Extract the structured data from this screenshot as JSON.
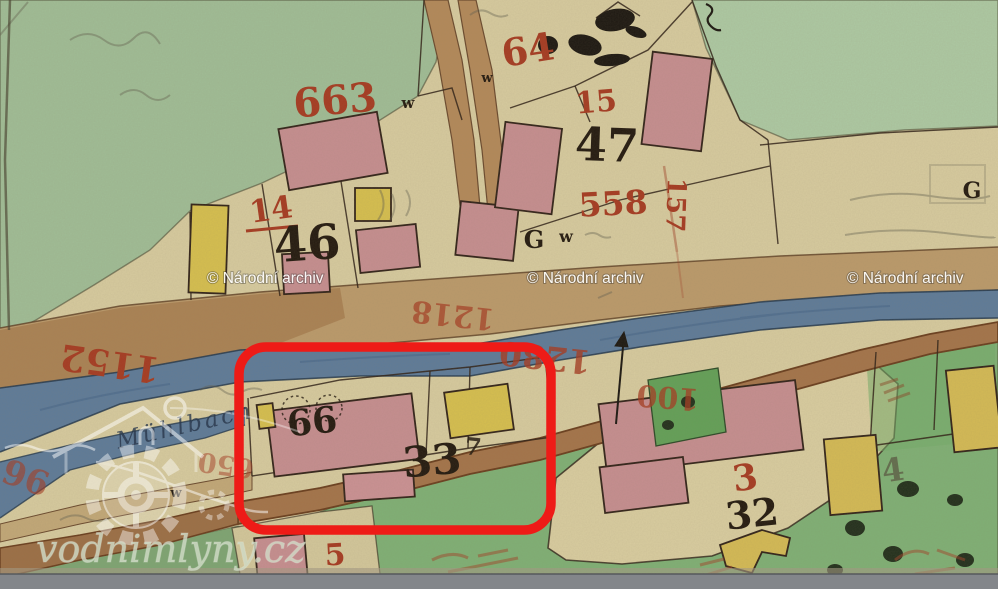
{
  "annotation": {
    "highlight_color": "#ee1b17"
  },
  "watermarks": {
    "archive": "© Národní archiv",
    "site": "vodnimlyny.cz"
  },
  "stream_name": "Mühlbach",
  "parcel_numbers_red": {
    "n663": "663",
    "n64": "64",
    "n15": "15",
    "n558": "558",
    "n157": "157",
    "n14": "14",
    "n1152": "1152",
    "n1218": "1218",
    "n1280": "1280",
    "n100": "100",
    "n650": "650",
    "n96": "96",
    "n3": "3",
    "n5": "5"
  },
  "house_numbers_black": {
    "n46": "46",
    "n47": "47",
    "n33": "33",
    "n33_flourish": "7",
    "n32": "32",
    "n66": "66"
  },
  "map_letters": {
    "g_street": "G",
    "w_street": "w",
    "g_field": "G",
    "w_small_a": "w",
    "w_small_b": "w",
    "w_small_c": "w",
    "pencil_4": "4"
  },
  "palette": {
    "paper": "#d7cb9f",
    "meadow": "#a0bd96",
    "meadow_right": "#adc9a3",
    "field_green": "#7fb075",
    "garden_green": "#63a058",
    "river": "#5e7b99",
    "road": "#bb9a6b",
    "road_dark": "#a4744a",
    "building_pink": "#c68e90",
    "building_yellow": "#d6bf4f",
    "ink_red": "#a63b22",
    "ink_black": "#241a10"
  }
}
